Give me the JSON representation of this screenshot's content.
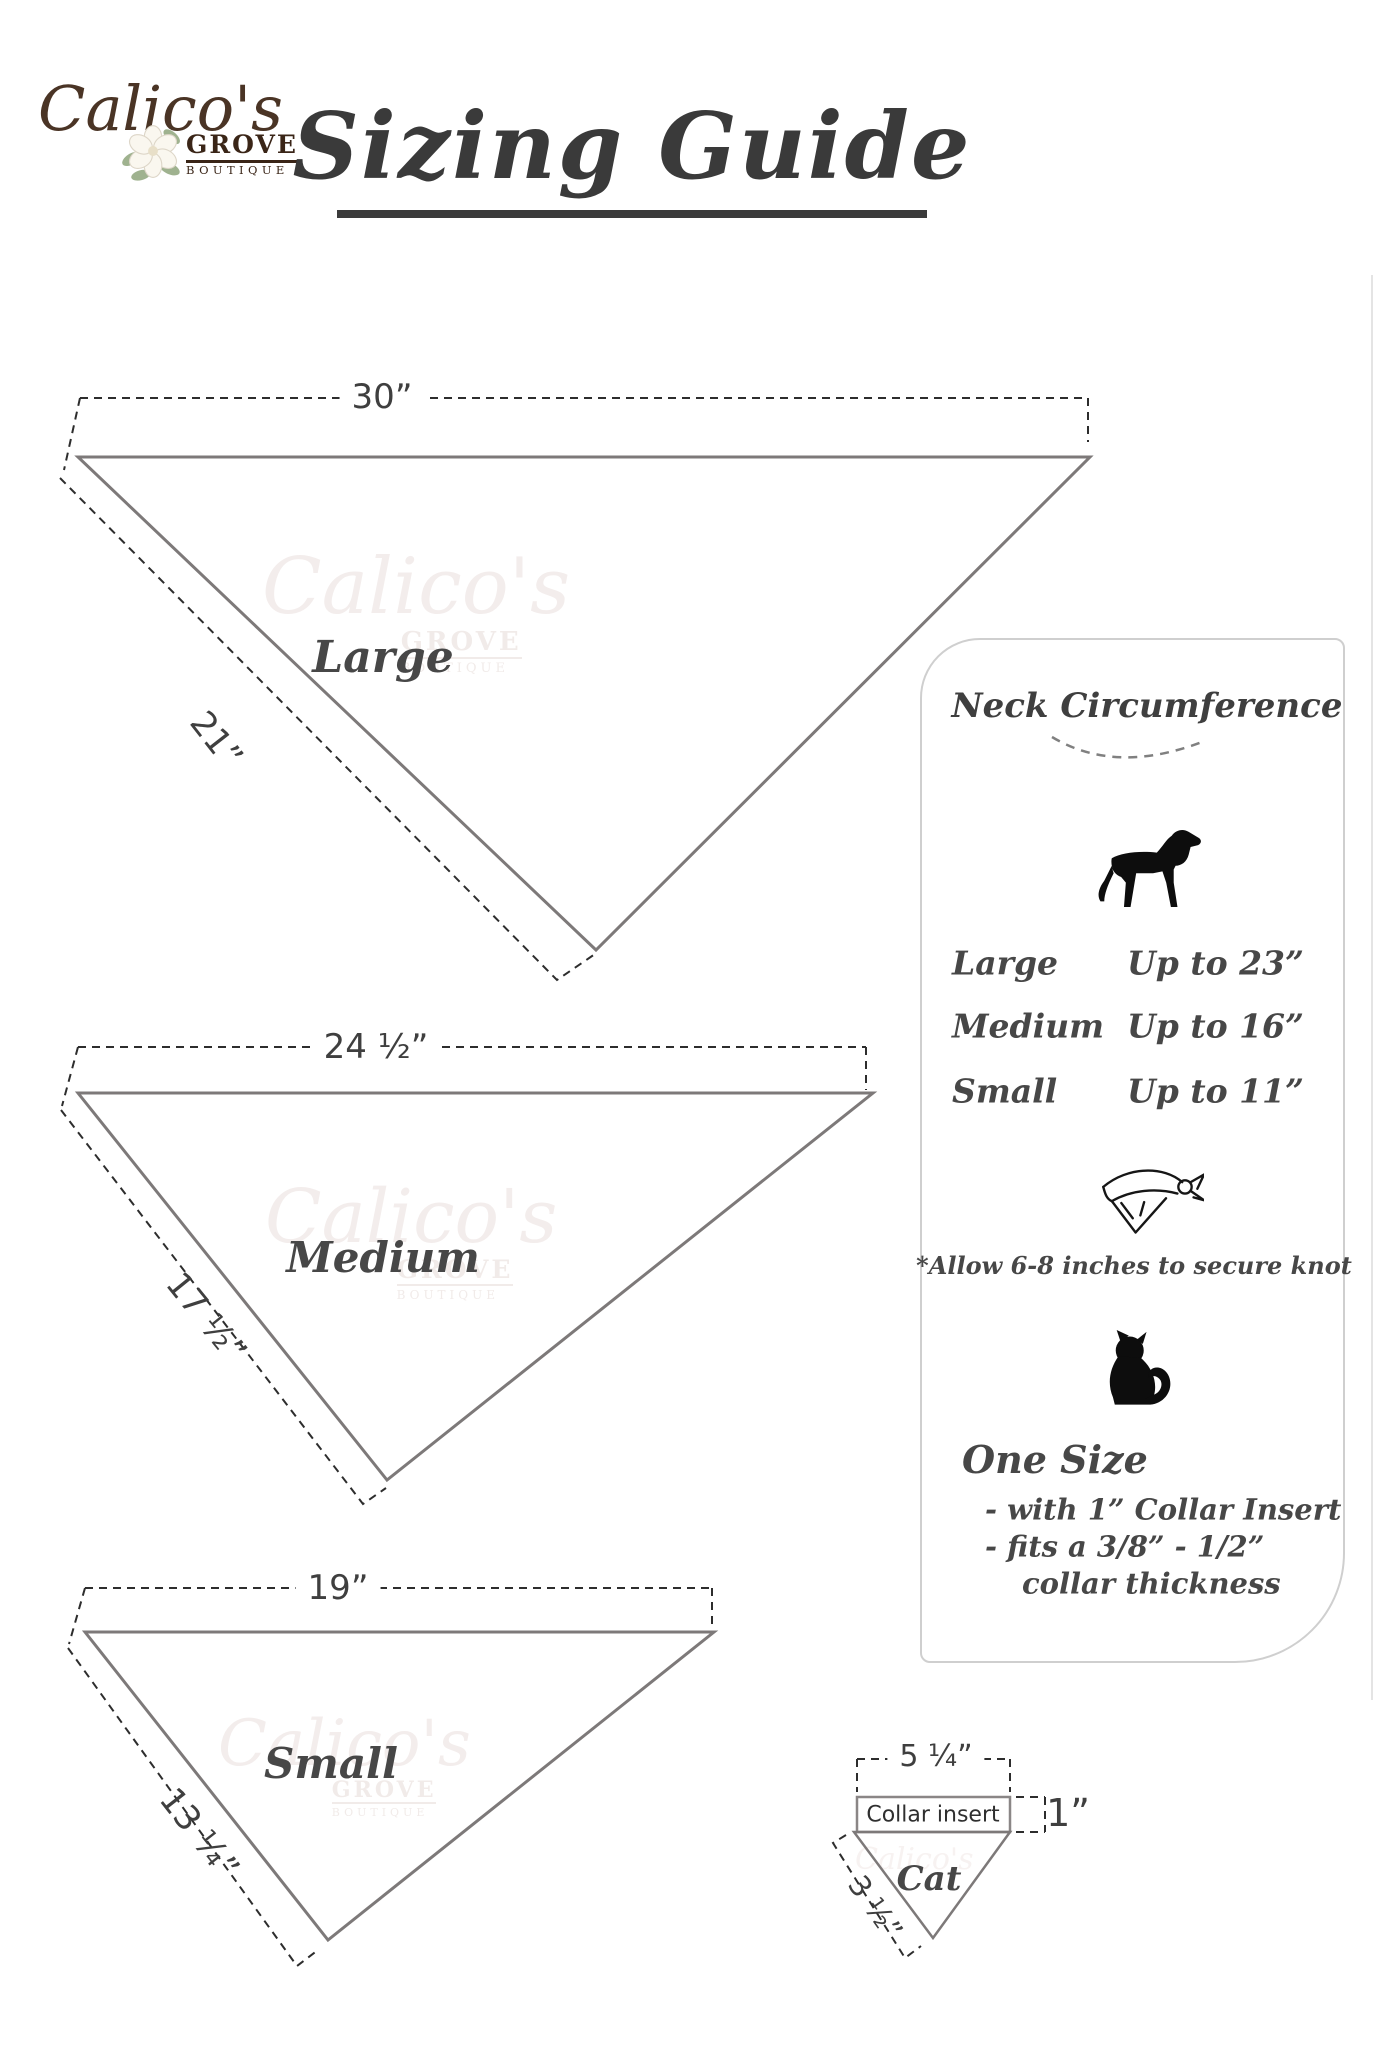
{
  "logo": {
    "script": "Calico's",
    "grove": "GROVE",
    "boutique": "BOUTIQUE"
  },
  "title": {
    "text": "Sizing Guide"
  },
  "bandanas": {
    "large": {
      "name": "Large",
      "top_width": "30”",
      "side_length": "21”"
    },
    "medium": {
      "name": "Medium",
      "top_width": "24 ½”",
      "side_length": "17 ½”"
    },
    "small": {
      "name": "Small",
      "top_width": "19”",
      "side_length": "13 ¼”"
    }
  },
  "panel": {
    "heading": "Neck Circumference",
    "dog_rows": [
      {
        "size": "Large",
        "fit": "Up to 23”"
      },
      {
        "size": "Medium",
        "fit": "Up to 16”"
      },
      {
        "size": "Small",
        "fit": "Up to 11”"
      }
    ],
    "knot_note": "*Allow 6-8 inches to secure knot",
    "cat_section": {
      "heading": "One Size",
      "line1": "- with 1” Collar Insert",
      "line2": "- fits a 3/8” - 1/2”",
      "line3": "collar thickness"
    }
  },
  "cat_diagram": {
    "name": "Cat",
    "collar_label": "Collar insert",
    "top_width": "5 ¼”",
    "insert_height": "1”",
    "side_length": "3 ½”"
  },
  "watermark": {
    "script": "Calico's",
    "grove": "GROVE",
    "boutique": "BOUTIQUE"
  },
  "colors": {
    "solid_line": "#7d7979",
    "dashed_line": "#2d2d2d",
    "text_dark": "#3f3f3f",
    "logo_brown": "#4a3425",
    "panel_border": "#cfcfcf"
  }
}
